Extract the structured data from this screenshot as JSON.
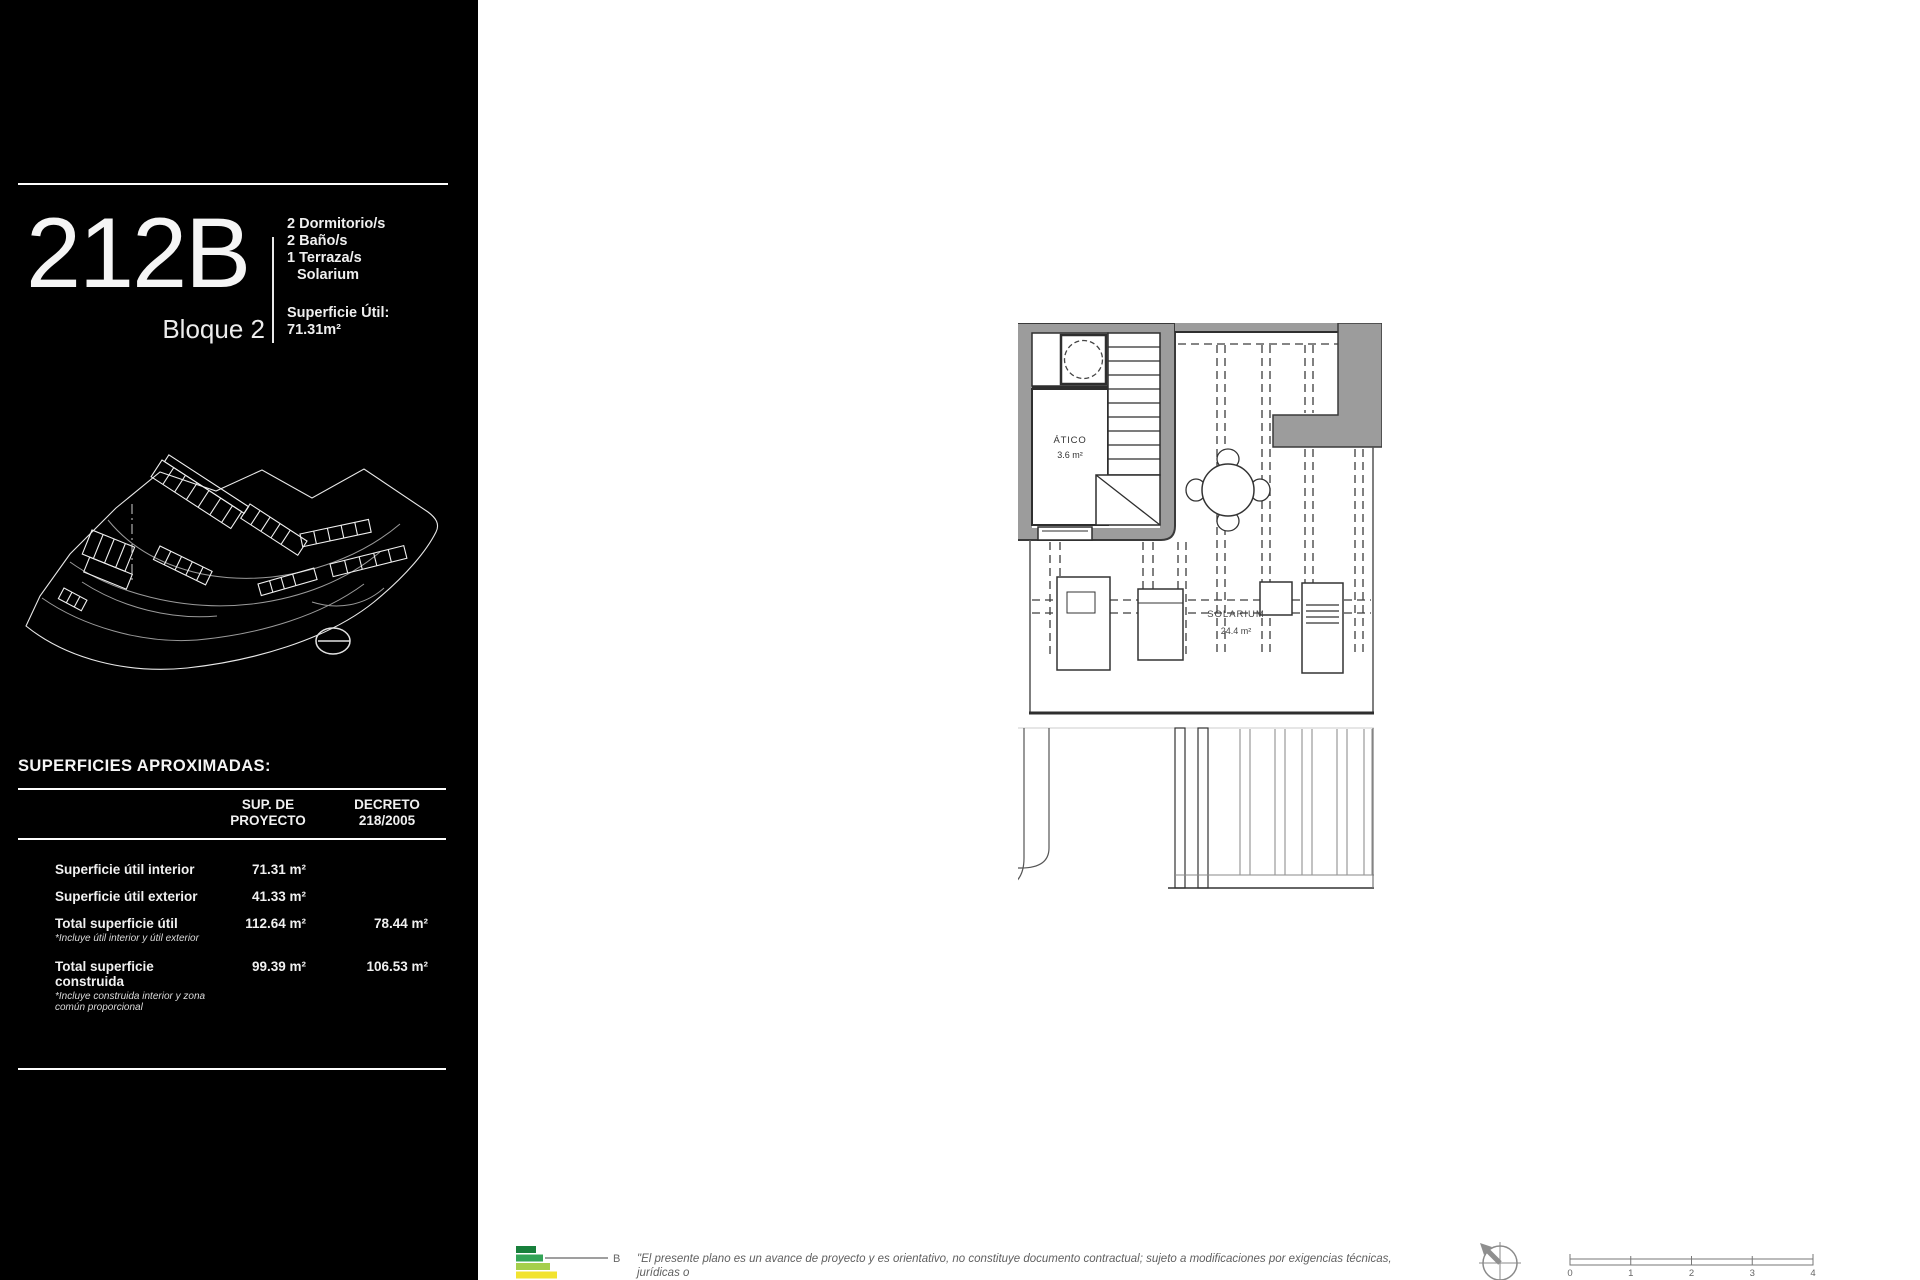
{
  "sidebar": {
    "unit_id": "212B",
    "block_label": "Bloque 2",
    "features": [
      "2 Dormitorio/s",
      "2 Baño/s",
      "1 Terraza/s",
      "Solarium"
    ],
    "superficie_util_label": "Superficie Útil:",
    "superficie_util_value": "71.31m²",
    "surfaces_heading": "SUPERFICIES APROXIMADAS:",
    "surfaces_table": {
      "col_project_line1": "SUP. DE",
      "col_project_line2": "PROYECTO",
      "col_decreto_line1": "DECRETO",
      "col_decreto_line2": "218/2005",
      "rows": [
        {
          "label": "Superficie útil interior",
          "note": "",
          "proyecto": "71.31 m²",
          "decreto": ""
        },
        {
          "label": "Superficie útil exterior",
          "note": "",
          "proyecto": "41.33 m²",
          "decreto": ""
        },
        {
          "label": "Total superficie útil",
          "note": "*Incluye útil interior y útil exterior",
          "proyecto": "112.64 m²",
          "decreto": "78.44 m²"
        },
        {
          "label": "Total superficie construida",
          "note": "*Incluye construida interior y zona común proporcional",
          "proyecto": "99.39 m²",
          "decreto": "106.53 m²"
        }
      ]
    }
  },
  "floor_plan": {
    "atico_label": "ÁTICO",
    "atico_area": "3.6 m²",
    "solarium_label": "SOLARIUM",
    "solarium_area": "24.4 m²"
  },
  "footer": {
    "energy_rating": "B",
    "disclaimer_line1": "\"El presente plano es un avance de proyecto y es orientativo, no constituye documento contractual; sujeto a modificaciones por exigencias técnicas, jurídicas o",
    "disclaimer_line2": "administrativas derivadas de la obtención de todos los permisos y licencias reglamentarios, así como las necesidades constructivas o de diseño derivadas del",
    "scale_ticks": [
      "0",
      "1",
      "2",
      "3",
      "4"
    ]
  },
  "colors": {
    "sidebar_bg": "#000000",
    "wall_gray": "#9c9c9c",
    "energy_dark_green": "#18803c",
    "energy_green": "#33a457",
    "energy_light_green": "#a5cf4c",
    "energy_yellow": "#f2e32f",
    "energy_orange": "#f0b040"
  }
}
